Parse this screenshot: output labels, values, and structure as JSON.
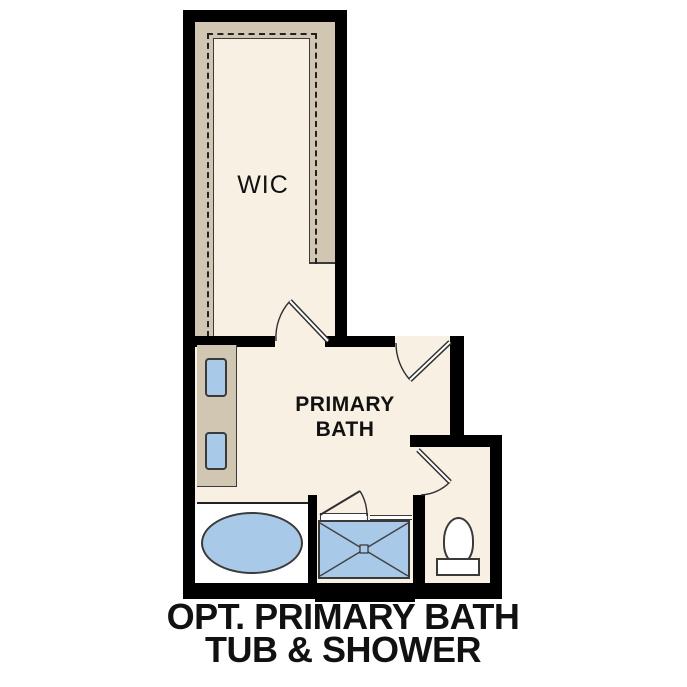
{
  "caption": {
    "line1": "OPT. PRIMARY BATH",
    "line2": "TUB & SHOWER"
  },
  "rooms": {
    "wic": {
      "label": "WIC"
    },
    "primary_bath": {
      "label_line1": "PRIMARY",
      "label_line2": "BATH"
    }
  },
  "fixtures": {
    "tub": "oval-bathtub-icon",
    "shower": "shower-pan-icon",
    "toilet": "toilet-icon",
    "sink_1": "sink-basin-icon",
    "sink_2": "sink-basin-icon",
    "vanity": "vanity-counter",
    "closet_rod": "dashed-closet-rod-line"
  },
  "colors": {
    "wall": "#000000",
    "floor": "#f7f0e3",
    "cabinet": "#d1c6b1",
    "fixture": "#a9c9e9",
    "outline": "#3a3a3a",
    "text": "#111111"
  }
}
